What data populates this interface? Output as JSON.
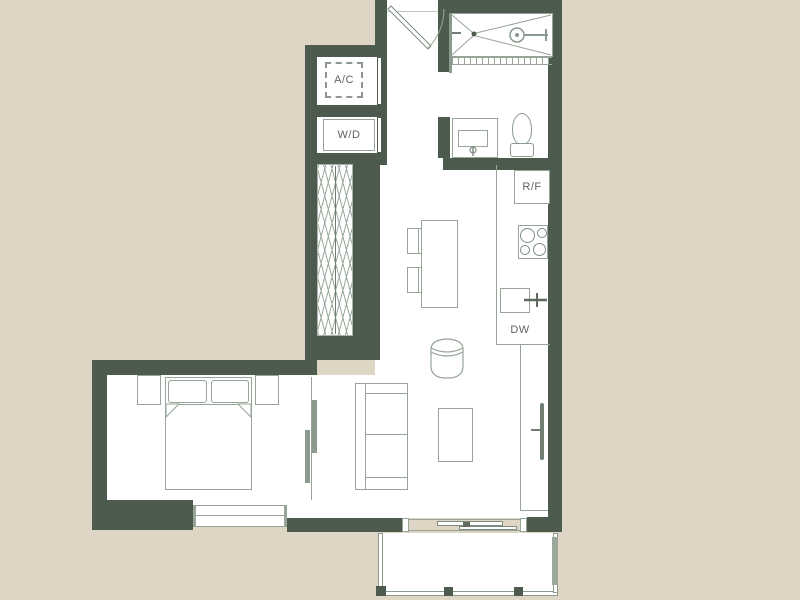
{
  "floorplan": {
    "labels": {
      "ac_closet": "A/C",
      "washer_dryer": "W/D",
      "refrigerator": "R/F",
      "dishwasher": "DW"
    },
    "colors": {
      "background": "#ded5c5",
      "wall": "#4d5a4e",
      "floor": "#ffffff",
      "furniture_line": "#96a598",
      "rail_line": "#8a9a8e",
      "label_text": "#5c645c"
    }
  }
}
